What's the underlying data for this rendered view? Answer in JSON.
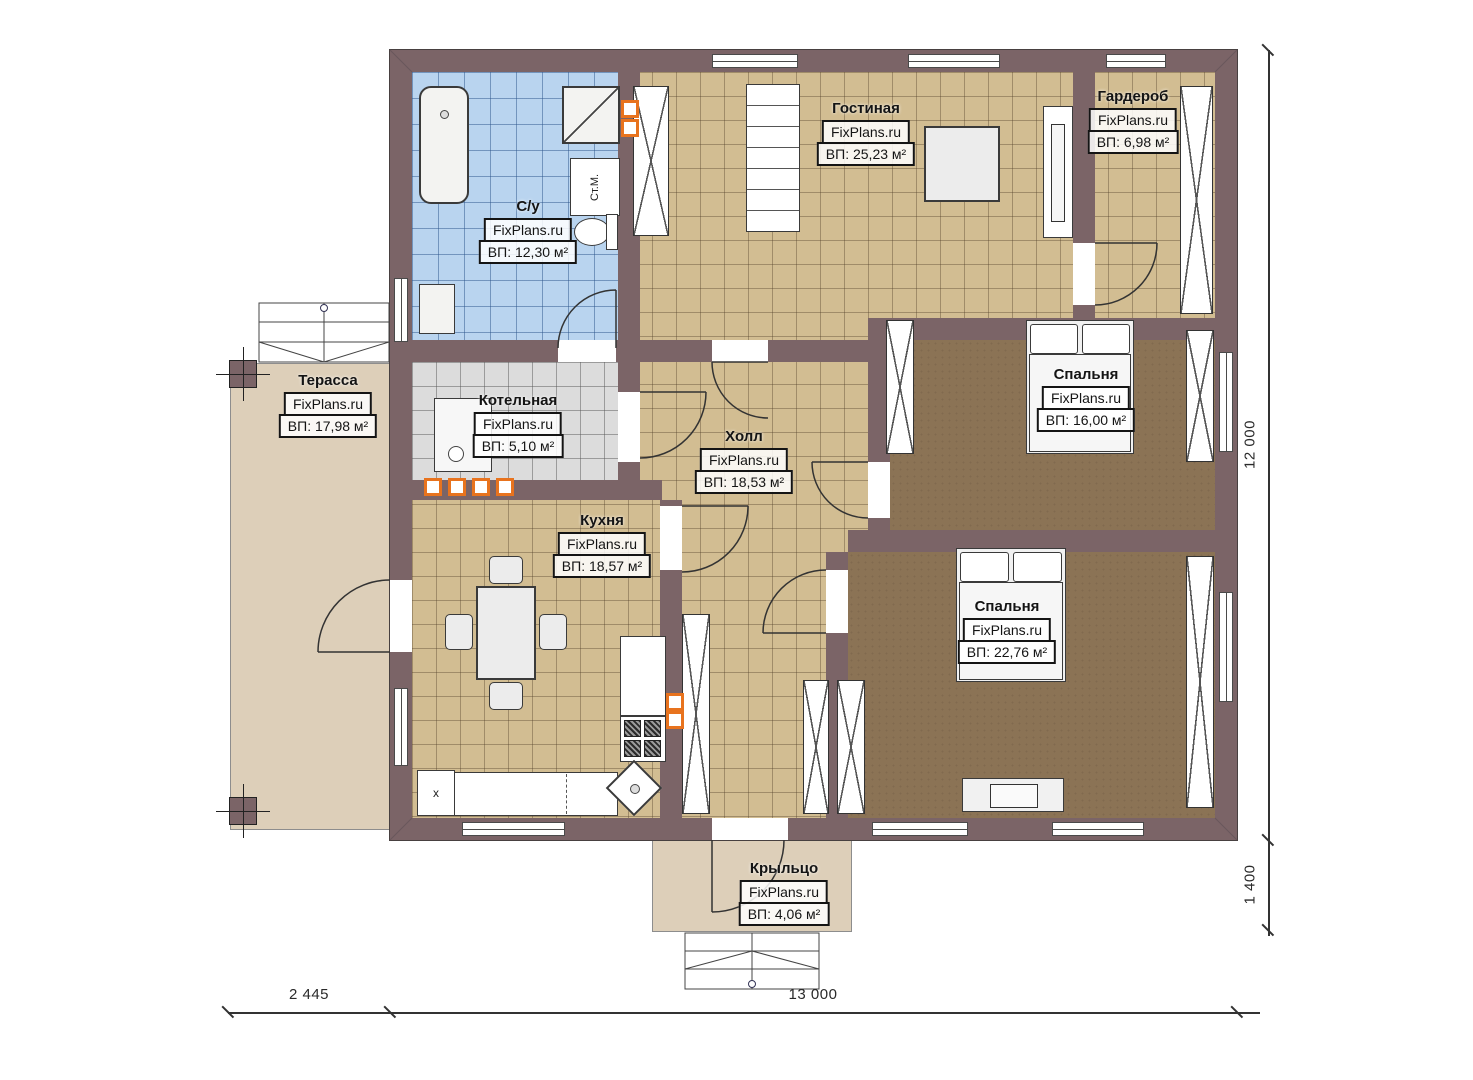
{
  "watermark": "FixPlans.ru",
  "rooms": [
    {
      "name": "Гостиная",
      "area": "ВП: 25,23 м²"
    },
    {
      "name": "Гардероб",
      "area": "ВП: 6,98 м²"
    },
    {
      "name": "С/у",
      "area": "ВП: 12,30 м²"
    },
    {
      "name": "Терасса",
      "area": "ВП: 17,98 м²"
    },
    {
      "name": "Котельная",
      "area": "ВП: 5,10 м²"
    },
    {
      "name": "Холл",
      "area": "ВП: 18,53 м²"
    },
    {
      "name": "Кухня",
      "area": "ВП: 18,57 м²"
    },
    {
      "name": "Спальня",
      "area": "ВП: 16,00 м²"
    },
    {
      "name": "Спальня",
      "area": "ВП: 22,76 м²"
    },
    {
      "name": "Крыльцо",
      "area": "ВП: 4,06 м²"
    }
  ],
  "annotations": {
    "washing_machine": "Ст.М.",
    "kitchen_corner": "x"
  },
  "dimensions": {
    "terrace_width": "2 445",
    "house_width": "13 000",
    "house_height": "12 000",
    "porch_depth": "1 400"
  },
  "colors": {
    "wall": "#7b6467",
    "tile_beige": "#d2bd92",
    "tile_blue": "#b9d4ef",
    "tile_gray": "#dcdcdc",
    "carpet_brown": "#8b7355",
    "deck_beige": "#ddcfb9",
    "accent_orange": "#e8731e"
  }
}
